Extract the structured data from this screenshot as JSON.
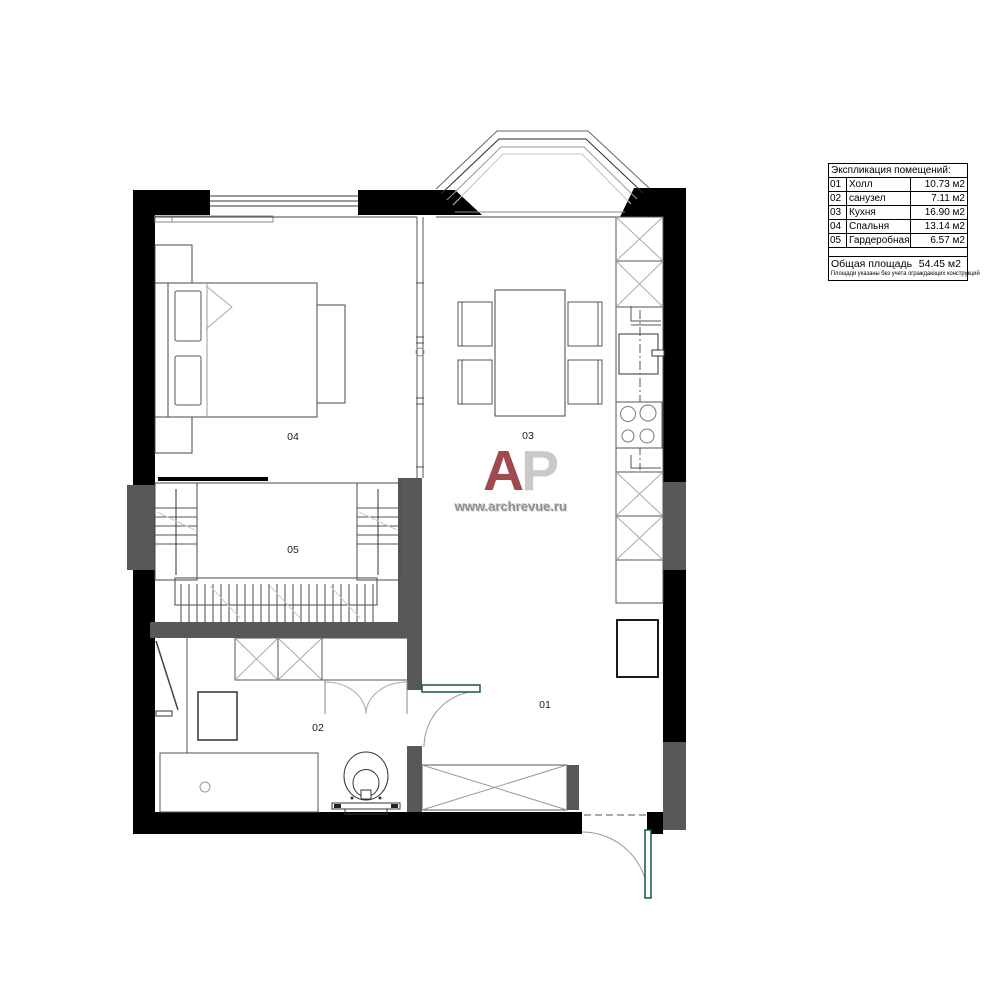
{
  "legend": {
    "title": "Экспликация помещений:",
    "rows": [
      {
        "num": "01",
        "name": "Холл",
        "area": "10.73 м2"
      },
      {
        "num": "02",
        "name": "санузел",
        "area": "7.11 м2"
      },
      {
        "num": "03",
        "name": "Кухня",
        "area": "16.90 м2"
      },
      {
        "num": "04",
        "name": "Спальня",
        "area": "13.14 м2"
      },
      {
        "num": "05",
        "name": "Гардеробная",
        "area": "6.57 м2"
      }
    ],
    "total_label": "Общая площадь",
    "total_value": "54.45 м2",
    "footnote": "Площади указаны без учета ограждающих конструкций"
  },
  "watermark": {
    "letter_a": "A",
    "letter_p": "P",
    "url": "www.archrevue.ru"
  },
  "colors": {
    "wall_black": "#000000",
    "wall_gray": "#585858",
    "door_green": "#15574a",
    "watermark_red": "#a04a4f",
    "watermark_gray": "#c9c9c9"
  }
}
